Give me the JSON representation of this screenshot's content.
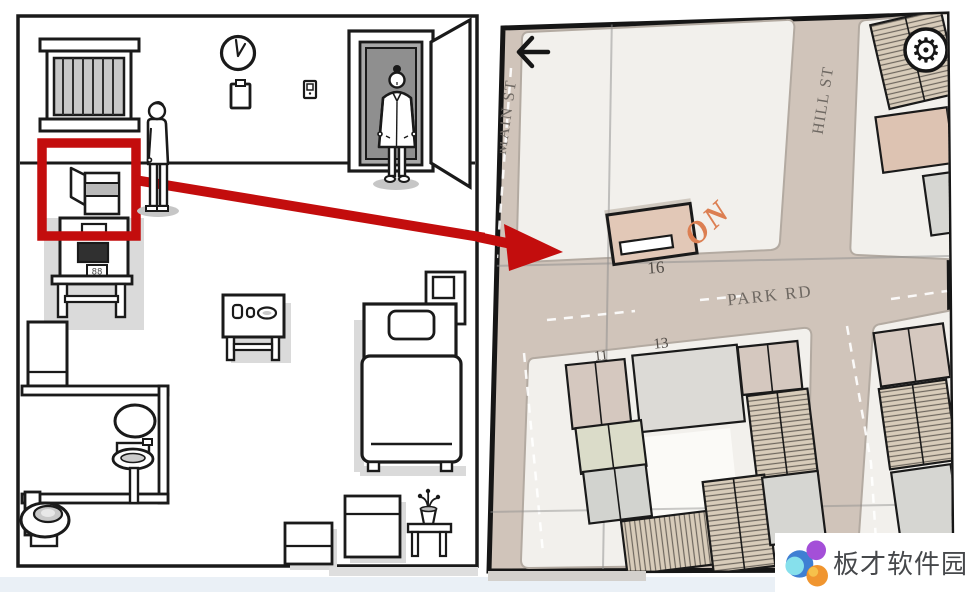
{
  "room": {
    "machine_display": "88"
  },
  "map": {
    "streets": {
      "main": "MAIN ST",
      "hill": "HILL ST",
      "park": "PARK RD"
    },
    "note": "ON",
    "house_numbers": {
      "target": "16",
      "west": "11",
      "east": "13"
    },
    "icons": {
      "back": "←",
      "settings": "⚙"
    }
  },
  "watermark": {
    "text": "板才软件园"
  },
  "colors": {
    "annotation_red": "#c30d0d",
    "street_beige": "#d0c4ba",
    "block_light": "#f2f0ec",
    "building_tan": "#d5c8bf",
    "target_building": "#e2c8b7",
    "note_orange": "#dc7f52"
  }
}
